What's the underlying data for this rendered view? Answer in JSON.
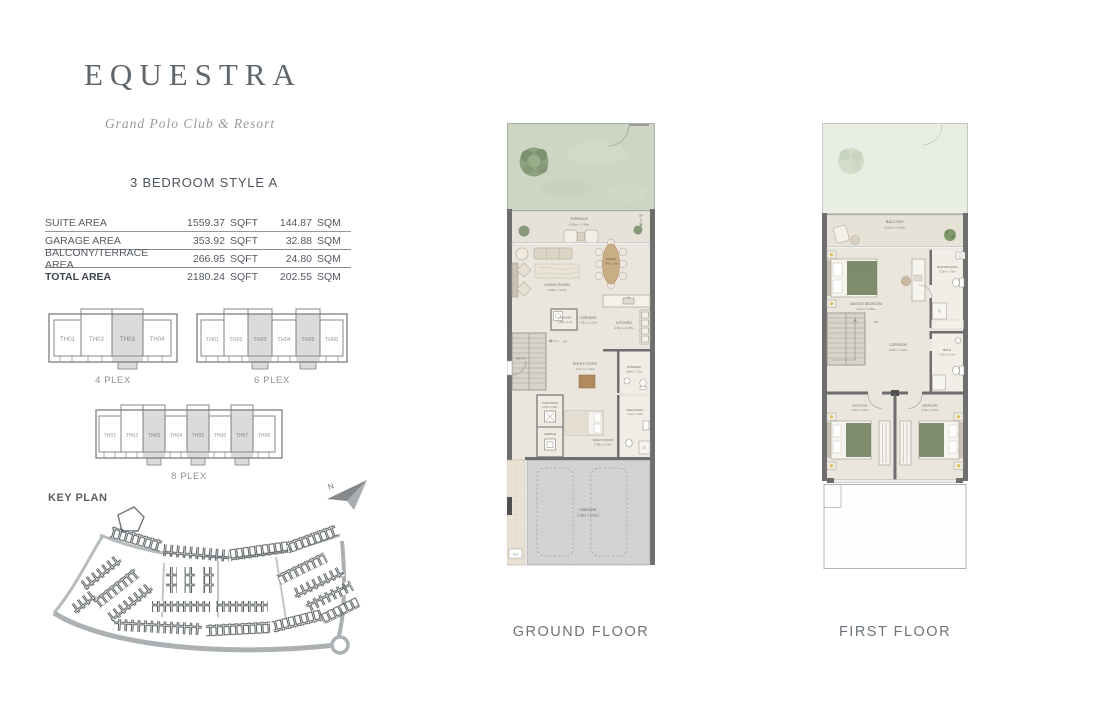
{
  "brand": {
    "name": "EQUESTRA",
    "tagline": "Grand Polo Club & Resort"
  },
  "unit": {
    "type_label": "3 BEDROOM STYLE A"
  },
  "area_table": {
    "rows": [
      {
        "label": "SUITE AREA",
        "sqft": "1559.37",
        "sqft_unit": "SQFT",
        "sqm": "144.87",
        "sqm_unit": "SQM"
      },
      {
        "label": "GARAGE AREA",
        "sqft": "353.92",
        "sqft_unit": "SQFT",
        "sqm": "32.88",
        "sqm_unit": "SQM"
      },
      {
        "label": "BALCONY/TERRACE AREA",
        "sqft": "266.95",
        "sqft_unit": "SQFT",
        "sqm": "24.80",
        "sqm_unit": "SQM"
      },
      {
        "label": "TOTAL AREA",
        "sqft": "2180.24",
        "sqft_unit": "SQFT",
        "sqm": "202.55",
        "sqm_unit": "SQM"
      }
    ]
  },
  "plex": {
    "p4": {
      "label": "4 PLEX",
      "units": [
        "TH01",
        "TH02",
        "TH03",
        "TH04"
      ],
      "highlighted": [
        "TH03"
      ]
    },
    "p6": {
      "label": "6 PLEX",
      "units": [
        "TH01",
        "TH02",
        "TH03",
        "TH04",
        "TH05",
        "TH06"
      ],
      "highlighted": [
        "TH03",
        "TH05"
      ]
    },
    "p8": {
      "label": "8 PLEX",
      "units": [
        "TH01",
        "TH02",
        "TH03",
        "TH04",
        "TH05",
        "TH06",
        "TH07",
        "TH08"
      ],
      "highlighted": [
        "TH03",
        "TH05",
        "TH07"
      ]
    }
  },
  "key_plan": {
    "label": "KEY PLAN",
    "north": "N"
  },
  "floors": {
    "ground": {
      "label": "GROUND FLOOR",
      "rooms": {
        "terrace": {
          "name": "TERRACE",
          "dims": "6.50m x 1.43m"
        },
        "living_room": {
          "name": "LIVING ROOM",
          "dims": "3.98m x 3.8m"
        },
        "dining": {
          "name": "DINING",
          "dims": "1.44m x 3.6m"
        },
        "laundry": {
          "name": "LAUNDRY",
          "dims": "1.28m x 1.0m"
        },
        "corridor": {
          "name": "CORRIDOR",
          "dims": "3.28m x 1.15m"
        },
        "kitchen": {
          "name": "KITCHEN",
          "dims": "2.80m x 2.08m"
        },
        "entry": {
          "name": "ENTRY"
        },
        "entry_foyer": {
          "name": "ENTRY FOYER",
          "dims": "3.31m x 1.33m"
        },
        "powder": {
          "name": "POWDER",
          "dims": "1.88m x 1.71m"
        },
        "pump_room": {
          "name": "PUMP ROOM",
          "dims": "0.95m x 0.85m"
        },
        "garbage": {
          "name": "GARBAGE"
        },
        "maids_room": {
          "name": "MAID'S ROOM",
          "dims": "2.45m x 2.04m"
        },
        "maids_bath": {
          "name": "MAID'S BATH",
          "dims": "1.91m x 1.20m"
        },
        "garage": {
          "name": "GARAGE",
          "dims": "5.50m x 5.50m"
        },
        "up": {
          "name": "UP"
        },
        "rm": {
          "name": "RM"
        }
      }
    },
    "first": {
      "label": "FIRST FLOOR",
      "rooms": {
        "balcony": {
          "name": "BALCONY",
          "dims": "6.52m x 1.40m"
        },
        "master_bedroom": {
          "name": "MASTER BEDROOM",
          "dims": "4.76m x 3.99m"
        },
        "master_bath": {
          "name": "MASTER BATH",
          "dims": "3.20m x 1.70m"
        },
        "bath": {
          "name": "BATH",
          "dims": "2.73m x 1.70m"
        },
        "corridor": {
          "name": "CORRIDOR",
          "dims": "3.69m x 1.25m"
        },
        "bedroom_left": {
          "name": "BEDROOM",
          "dims": "4.15m x 3.25m"
        },
        "bedroom_right": {
          "name": "BEDROOM",
          "dims": "4.15m x 3.25m"
        },
        "dn": {
          "name": "DN"
        }
      }
    }
  },
  "colors": {
    "brand_text": "#5f666b",
    "plex_highlight": "#dbdbdb",
    "garden_green": "#cdd6c2",
    "duvet_green": "#7e8c6b",
    "wood": "#c9ad85",
    "wall_gray": "#6e6e6e"
  }
}
